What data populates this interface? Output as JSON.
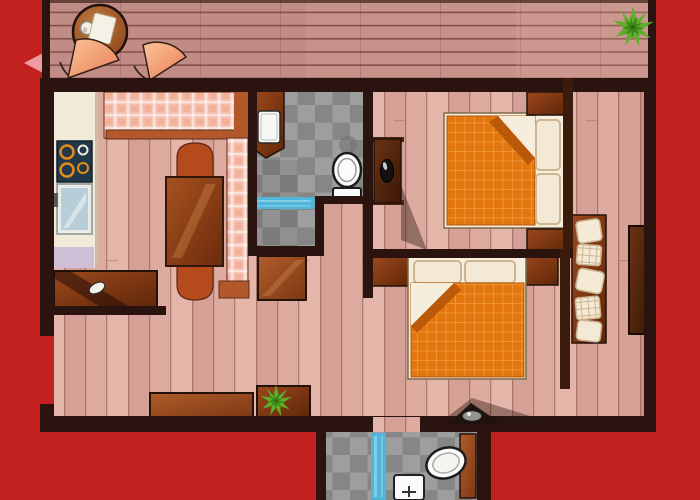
{
  "scene": {
    "title": "Apartment floor plan illustration",
    "rooms": [
      {
        "id": "deck",
        "label": "balcony-deck"
      },
      {
        "id": "living-kitchen",
        "label": "living-room-and-kitchen"
      },
      {
        "id": "bathroom-main",
        "label": "main-bathroom"
      },
      {
        "id": "bedroom-1",
        "label": "bedroom-top"
      },
      {
        "id": "bedroom-2",
        "label": "bedroom-bottom"
      },
      {
        "id": "corridor",
        "label": "right-corridor"
      },
      {
        "id": "bathroom-lower",
        "label": "lower-bathroom"
      }
    ],
    "items": {
      "deck": [
        "round-table",
        "napkin",
        "cup",
        "fan-chair",
        "fan-chair",
        "potted-plant"
      ],
      "living_kitchen": [
        "kitchen-counter",
        "stove",
        "glass-fridge",
        "lavender-mat",
        "corner-sofa",
        "dining-table",
        "arch-chair",
        "arch-chair",
        "console-table",
        "bowl",
        "sideboard",
        "plant-sideboard",
        "potted-plant",
        "door-leaf"
      ],
      "bathroom_main": [
        "washing-machine-cabinet",
        "washing-machine",
        "toilet",
        "blue-bath-mat"
      ],
      "bedroom_1": [
        "vanity-dresser",
        "black-basin",
        "double-bed",
        "pillow",
        "pillow",
        "orange-blanket",
        "nightstand",
        "nightstand"
      ],
      "bedroom_2": [
        "double-bed",
        "pillow",
        "pillow",
        "orange-blanket",
        "nightstand",
        "nightstand",
        "wall-sink"
      ],
      "corridor": [
        "cushion-shelf",
        "cushion",
        "wardrobe-cabinet"
      ],
      "bathroom_lower": [
        "bathtub",
        "wash-basin",
        "blue-shower-mat",
        "door-leaf"
      ]
    }
  },
  "palette": {
    "bg_red": "#c32020",
    "arrow_pink": "#f0a9b2",
    "wall": "#2b1410",
    "wall_brown": "#3a1b0c",
    "deck_base": "#c6928a",
    "deck_line": "#6f4037",
    "floor_base": "#ddaba0",
    "floor_alt1": "#d5a095",
    "floor_alt2": "#e4b6aa",
    "floor_line": "#9b675b",
    "tile_light": "#9e9e9e",
    "tile_dark": "#868686",
    "counter": "#f2ead8",
    "stove": "#223949",
    "burner": "#e78a1e",
    "burner_pale": "#f2e8da",
    "fridge_frame": "#e9ece9",
    "fridge_glass": "#b7ced8",
    "handle_gray": "#5a5a5a",
    "lavender": "#cfc0d8",
    "plaid_base": "#f4bfae",
    "plaid_accent": "#ee8a64",
    "sofa_wood": "#b2582b",
    "chair_rust": "#b54a1c",
    "white": "#ffffff",
    "cream": "#f5efe2",
    "bed_frame": "#f6eedd",
    "pillow": "#f3e9d4",
    "pillow_line": "#cdb592",
    "blanket": "#e2760f",
    "blanket_grid": "#f49b3a",
    "blanket_fold": "#b55708",
    "mat_blue": "#4fb6da",
    "mat_blue_light": "#8fd4ea",
    "plant": "#5fae2a",
    "plant_dark": "#3c8518",
    "outline": "#23120a",
    "sink_black": "#15100f",
    "porcelain": "#fbfbf9",
    "steel": "#96948e",
    "shadow": "rgba(40,18,12,0.40)",
    "wood_table_hi": "#a8521f",
    "wood_table_lo": "#6b2b0c",
    "wood_door_hi": "#b05d2a",
    "wood_door_lo": "#7c3813",
    "wood_cab_hi": "#9c481d",
    "wood_cab_lo": "#5f2708",
    "wood_dark_hi": "#6b3313",
    "wood_dark_lo": "#3a1806",
    "fan_hi": "#f9c496",
    "fan_lo": "#eb7d58",
    "table_top_hi": "#c07a40",
    "table_top_lo": "#89431a"
  }
}
